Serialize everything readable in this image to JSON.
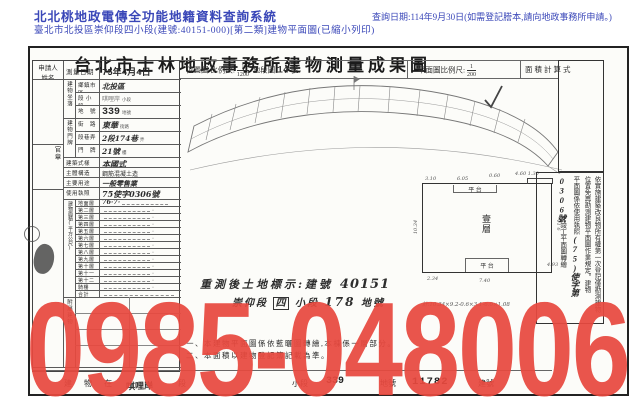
{
  "header": {
    "system_title": "北北桃地政電傳全功能地籍資料查詢系統",
    "query_date": "查詢日期:114年9月30日(如需登記謄本,請向地政事務所申請。)",
    "subtitle": "臺北市北投區崇仰段四小段(建號:40151-000)[第二類]建物平面圖(已縮小列印)",
    "text_color": "#3a47b8"
  },
  "document": {
    "title": "台北市士林地政事務所建物測量成果圖",
    "scale_row": {
      "location_label": "位置圖 比例尺:",
      "location_scale_num": "1",
      "location_scale_den": "1200",
      "sheet_label": "地段圖",
      "sheet_no": "14",
      "sheet_suffix": "號",
      "plan_label": "平面圖比例尺:",
      "plan_scale_num": "1",
      "plan_scale_den": "200",
      "area_calc_label": "面積計算式"
    },
    "applicant_label": "申請人 姓名",
    "seal_label": "官章",
    "survey": {
      "label": "測量日期",
      "value": "75年4月4日"
    },
    "location_group": {
      "label": "建物坐落",
      "rows": [
        {
          "label": "鄉鎮市區",
          "value": "北投區",
          "suffix": ""
        },
        {
          "label": "段 小段",
          "value": "唭哩岸",
          "suffix": "小段"
        },
        {
          "label": "地　號",
          "value": "339",
          "suffix": "地號"
        }
      ]
    },
    "address_group": {
      "label": "建物門牌",
      "rows": [
        {
          "label": "街　路",
          "value": "東華",
          "suffix": "街路"
        },
        {
          "label": "段巷弄",
          "value": "2段174巷",
          "suffix": "弄"
        },
        {
          "label": "門　牌",
          "value": "21號",
          "suffix": "樓"
        }
      ]
    },
    "building_group": {
      "rows": [
        {
          "label": "建築式樣",
          "value": "本國式"
        },
        {
          "label": "主體構造",
          "value": "鋼筋混凝土造"
        },
        {
          "label": "主要用途",
          "value": "一般零售業"
        },
        {
          "label": "使用執照",
          "value": "75使字0306號"
        }
      ]
    },
    "floors": {
      "group_label": "建物面積(平方公尺)",
      "labels": [
        "地面層",
        "第二層",
        "第三層",
        "第四層",
        "第五層",
        "第六層",
        "第七層",
        "第八層",
        "第九層",
        "第十層",
        "第十一層",
        "第十二層",
        "騎樓",
        "合計"
      ],
      "values": [
        "76·7·",
        "·",
        "·",
        "·",
        "·",
        "·",
        "·",
        "·",
        "·",
        "·",
        "·",
        "·",
        "·",
        ""
      ]
    },
    "annex_label": "附屬建物",
    "resurvey": {
      "prefix": "重測後土地標示:建號",
      "building_no": "40151",
      "section": "崇仰段",
      "subsection_boxed": "四",
      "subsection_suffix": "小段",
      "lot_no": "178",
      "lot_suffix": "地號"
    },
    "floor_plan": {
      "room_label": "壹層",
      "top_label": "平 台",
      "bottom_label": "平 台",
      "dims": [
        "3.10",
        "6.05",
        "0.60",
        "4.60 1.30",
        "10.34",
        "9.11",
        "2.34",
        "7.40",
        "4.93"
      ],
      "calc_note": "計:10.34×9.2-0.6×3.1-6.0×1.08"
    },
    "sidebar": {
      "col1": "依實施建築改良物所有權第一次登記僅勘測建物",
      "col2": "位置免再勘測建物平面圖作業規定。建物",
      "col3_prefix": "平面圖係依使用執照",
      "col3_permit": "(75)使字第0306號",
      "col3_suffix": "竣工平面圖轉繪"
    },
    "notes": {
      "line1": "一、本建物平面圖係依藍曬圖轉繪,本棟係一層部分。",
      "line2": "二、本面積以建物登記簿記載為準。"
    },
    "bottom_row": {
      "prefix": "建 物 在",
      "section_stamp": "唭哩岸",
      "section_suffix": "段",
      "subsection_suffix": "小段",
      "lot_no": "339",
      "lot_suffix": "地號",
      "building_no": "11782",
      "building_suffix": "建號"
    }
  },
  "watermark": {
    "text": "0985-048006",
    "color": "#e8493f"
  }
}
